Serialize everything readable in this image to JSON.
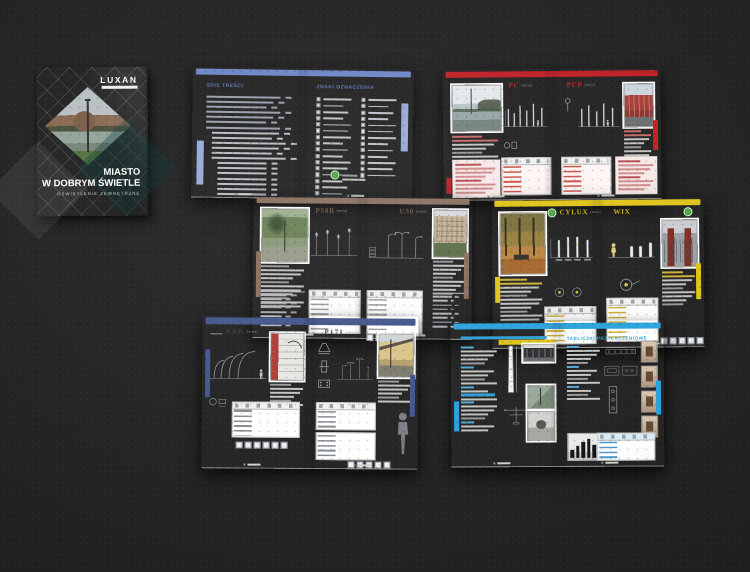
{
  "cover": {
    "logo": "LUXAN",
    "title1": "MIASTO",
    "title2": "W DOBRYM ŚWIETLE",
    "subtitle": "OŚWIETLENIE ZEWNĘTRZNE"
  },
  "spreads": {
    "toc": {
      "left_title": "SPIS TREŚCI",
      "right_title": "ZNAKI OZNACZENIA"
    },
    "pc": {
      "left_title": "PC",
      "left_series": "(seria)",
      "right_title": "PCP",
      "right_series": "(seria)"
    },
    "p50b": {
      "left_title": "P50B",
      "left_series": "(seria)",
      "right_title": "U50",
      "right_series": "(seria)"
    },
    "cylux": {
      "left_title": "CYLUX",
      "left_series": "(seria)",
      "right_title": "WIX"
    },
    "ark": {
      "left_title": "ARK",
      "left_series": "(seria)",
      "right_title": "P171",
      "right_series": "(seria)"
    },
    "tech": {
      "right_title": "TABLICZKI PRZYŁĄCZENIOWE"
    }
  },
  "icons": {
    "eco_badge": "green-eco-badge",
    "legend_symbol": "spec-symbol-square"
  },
  "colors": {
    "cover_teal": "#2b7370",
    "toc_blue": "#6f87c6",
    "pc_red": "#bf2227",
    "p50b_brown": "#8a7163",
    "cylux_yellow": "#dfc41c",
    "ark_navy": "#44578b",
    "tech_cyan": "#2ba3dc",
    "surface": "#242424"
  }
}
